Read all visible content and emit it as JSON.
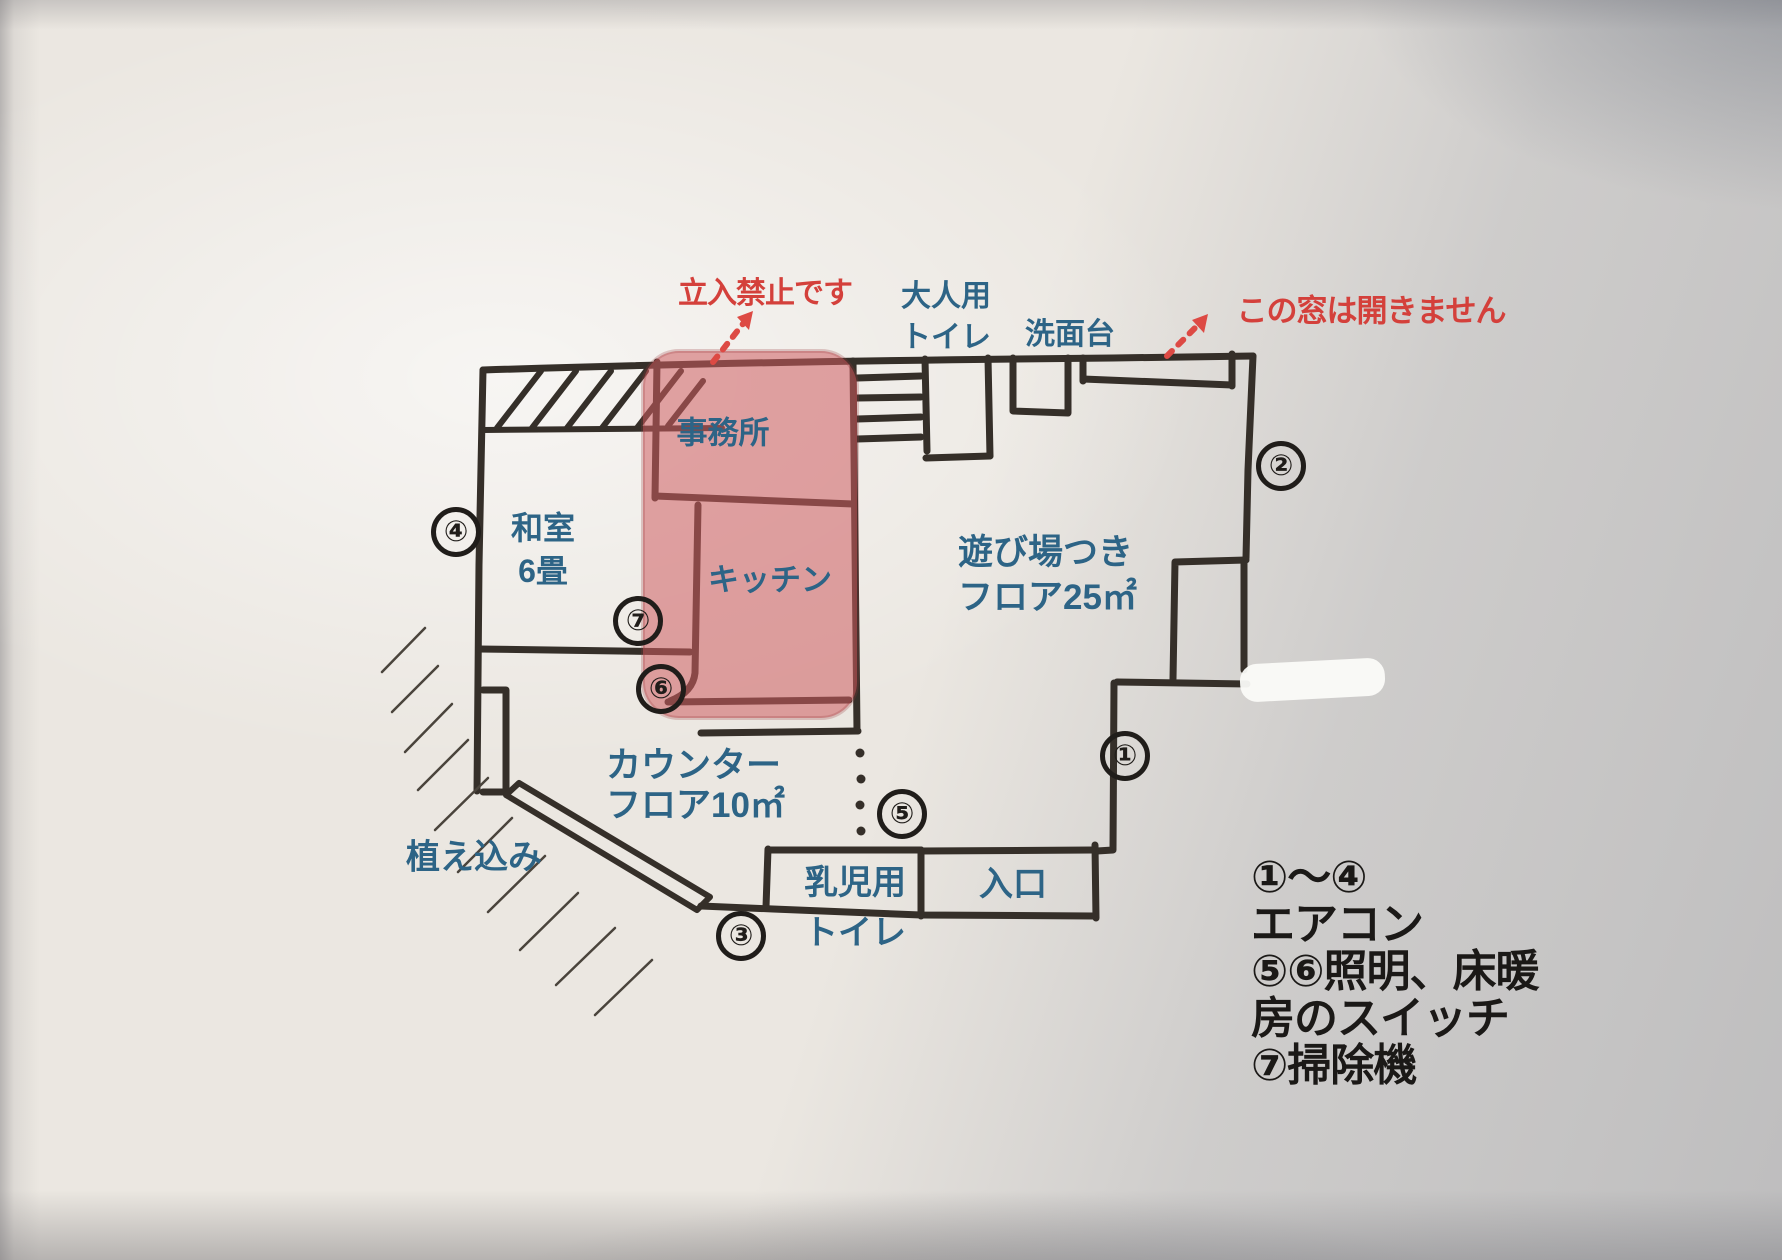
{
  "palette": {
    "ink": "#352f29",
    "room_label_blue": "#2d6486",
    "warning_red": "#d4403b",
    "pink_overlay": "rgba(205,92,97,0.55)",
    "legend_black": "#1b1917"
  },
  "plan": {
    "rooms": {
      "office": "事務所",
      "kitchen": "キッチン",
      "washitsu": [
        "和室",
        "6畳"
      ],
      "playroom": [
        "遊び場つき",
        "フロア25㎡"
      ],
      "counter": [
        "カウンター",
        "フロア10㎡"
      ],
      "infant_toilet": [
        "乳児用",
        "トイレ"
      ],
      "entrance": "入口",
      "adult_toilet": [
        "大人用",
        "トイレ"
      ],
      "washbasin": "洗面台",
      "planting": "植え込み"
    },
    "warnings": {
      "no_entry": "立入禁止です",
      "window": "この窓は開きません"
    },
    "markers": [
      "①",
      "②",
      "③",
      "④",
      "⑤",
      "⑥",
      "⑦"
    ]
  },
  "legend": {
    "lines": [
      "①～④",
      "エアコン",
      "⑤⑥照明、床暖",
      "房のスイッチ",
      "⑦掃除機"
    ]
  }
}
